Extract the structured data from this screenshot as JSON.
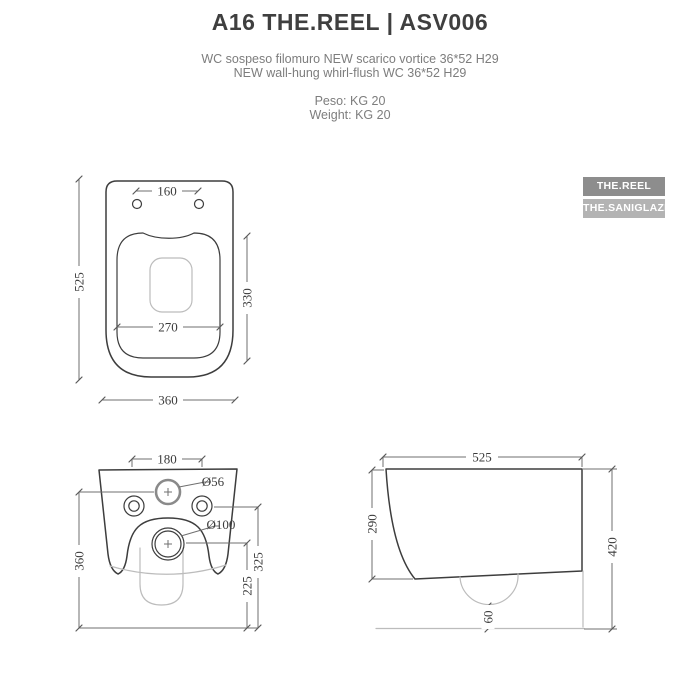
{
  "header": {
    "title": "A16 THE.REEL | ASV006",
    "subtitle_it": "WC sospeso filomuro NEW scarico vortice 36*52  H29",
    "subtitle_en": "NEW wall-hung whirl-flush WC 36*52  H29",
    "weight_it": "Peso: KG 20",
    "weight_en": "Weight: KG 20"
  },
  "badges": [
    {
      "label": "THE.REEL",
      "bg": "#8d8d8d"
    },
    {
      "label": "THE.SANIGLAZE",
      "bg": "#b3b3b3"
    }
  ],
  "colors": {
    "title_text": "#3f3f3f",
    "gray_text": "#7d7d7d",
    "outline_stroke": "#3d3d3d",
    "dimension_stroke": "#6f6f6f",
    "construction_stroke": "#bcbcbc",
    "badge_text": "#ffffff"
  },
  "drawings": {
    "top_view": {
      "hole_spacing": "160",
      "total_depth": "525",
      "seat_depth": "330",
      "seat_width": "270",
      "total_width": "360"
    },
    "rear_view": {
      "hole_spacing": "180",
      "inlet_diameter": "Ø56",
      "outlet_diameter": "Ø100",
      "inlet_height": "360",
      "holes_height": "325",
      "outlet_height": "225"
    },
    "side_view": {
      "total_depth": "525",
      "front_height": "290",
      "total_height": "420",
      "bottom_gap": "60"
    }
  }
}
